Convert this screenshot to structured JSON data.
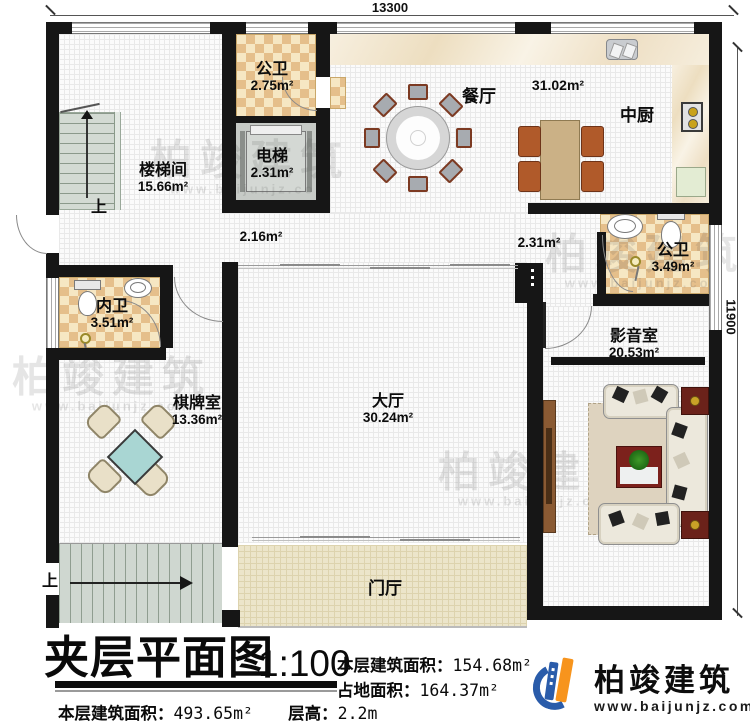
{
  "dimensions": {
    "top": "13300",
    "right": "11900"
  },
  "rooms": {
    "stairwell": {
      "name": "楼梯间",
      "area": "15.66m²"
    },
    "bath_top": {
      "name": "公卫",
      "area": "2.75m²"
    },
    "elevator": {
      "name": "电梯",
      "area": "2.31m²"
    },
    "dining": {
      "name": "餐厅"
    },
    "dining_kitchen": {
      "area": "31.02m²"
    },
    "kitchen": {
      "name": "中厨"
    },
    "bath_right": {
      "name": "公卫",
      "area": "3.49m²"
    },
    "bath_inner": {
      "name": "内卫",
      "area": "3.51m²"
    },
    "chess": {
      "name": "棋牌室",
      "area": "13.36m²"
    },
    "hall": {
      "name": "大厅",
      "area": "30.24m²"
    },
    "media": {
      "name": "影音室",
      "area": "20.53m²"
    },
    "foyer": {
      "name": "门厅"
    }
  },
  "corridor": {
    "left_area": "2.16m²",
    "right_area": "2.31m²"
  },
  "stairs": {
    "up": "上"
  },
  "title_block": {
    "title": "夹层平面图",
    "scale": "1:100",
    "floor_area_label": "本层建筑面积：",
    "floor_area_value": "154.68m²",
    "footprint_label": "占地面积：",
    "footprint_value": "164.37m²",
    "total_area_label": "本层建筑面积：",
    "total_area_value": "493.65m²",
    "height_label": "层高：",
    "height_value": "2.2m"
  },
  "branding": {
    "company": "柏竣建筑",
    "website": "www.baijunjz.com"
  },
  "icons": [
    "stair-up-arrow",
    "door-arc",
    "toilet-icon",
    "sink-icon",
    "stove-icon",
    "shower-icon",
    "sofa",
    "dining-table",
    "projection-screen"
  ],
  "colors": {
    "wall": "#161616",
    "checker_dark": "#e5bf8b",
    "checker_light": "#f6e7c3",
    "teal_table": "#a9d6d3",
    "logo_blue": "#2a5caa",
    "logo_orange": "#f7941d"
  }
}
